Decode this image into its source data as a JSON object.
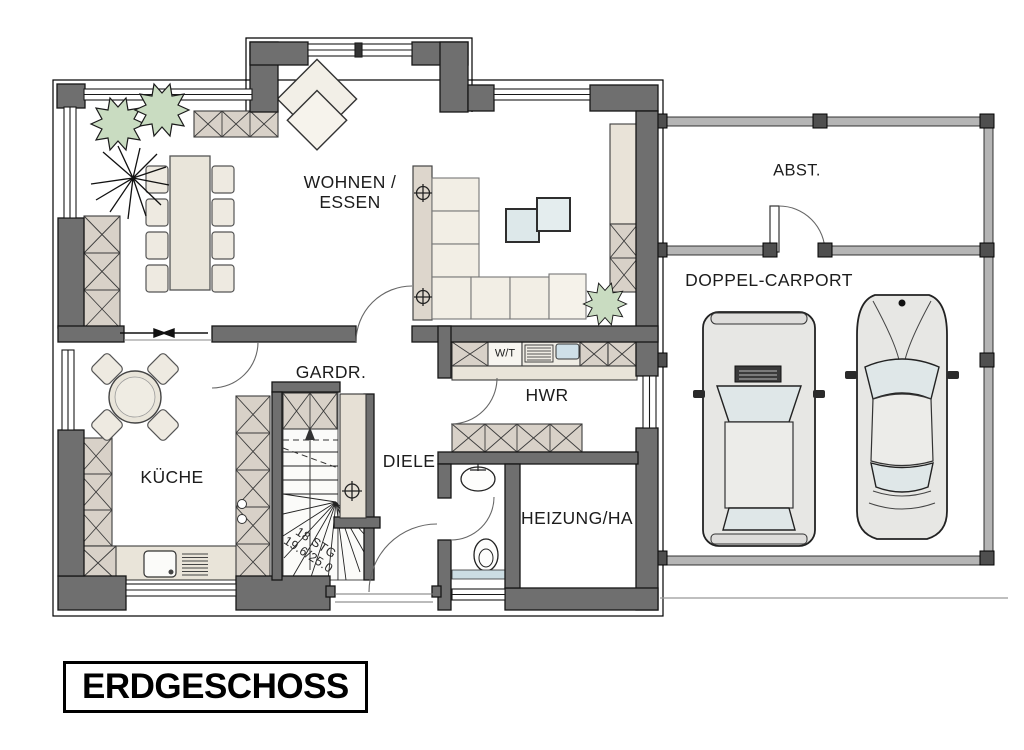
{
  "title": {
    "label": "ERDGESCHOSS"
  },
  "rooms": {
    "living_line1": "WOHNEN /",
    "living_line2": "ESSEN",
    "wardrobe": "GARDR.",
    "kitchen": "KÜCHE",
    "hallway": "DIELE",
    "utility": "HWR",
    "heating": "HEIZUNG/HA",
    "washer_dryer": "W/T",
    "storage": "ABST.",
    "carport": "DOPPEL-CARPORT"
  },
  "stairs": {
    "steps": "18 STG",
    "dimensions": "19.6/25.0"
  },
  "colors": {
    "wall": "#6f6f6f",
    "cabinet": "#d8d1c8",
    "furniture": "#efebe1",
    "sofa_cushion": "#f2eee5",
    "glass_table": "#dde8ea",
    "plant": "#c9dcc1",
    "carport_wall": "#b5b5b5",
    "carport_post": "#4f4f4f",
    "appliance_blue": "#cfe0e8"
  }
}
